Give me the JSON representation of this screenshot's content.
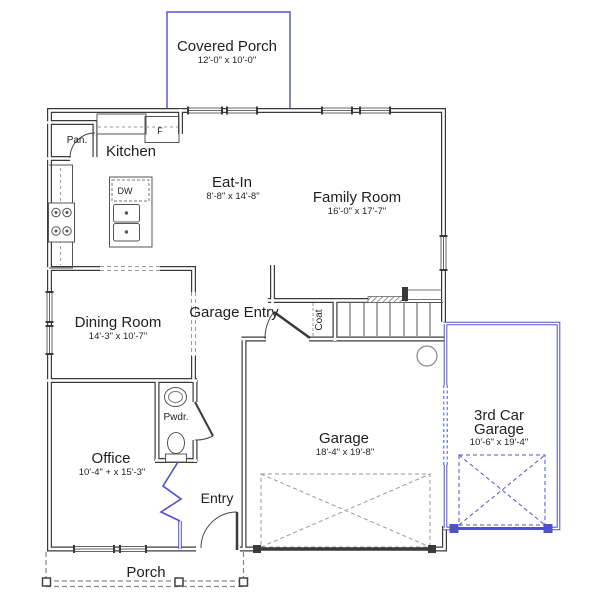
{
  "plan": {
    "rooms": {
      "covered_porch": {
        "name": "Covered Porch",
        "dims": "12'-0\" x 10'-0\""
      },
      "kitchen": {
        "name": "Kitchen"
      },
      "pantry": {
        "name": "Pan."
      },
      "eat_in": {
        "name": "Eat-In",
        "dims": "8'-8\" x 14'-8\""
      },
      "family_room": {
        "name": "Family Room",
        "dims": "16'-0\" x 17'-7\""
      },
      "dining_room": {
        "name": "Dining Room",
        "dims": "14'-3\" x 10'-7\""
      },
      "garage_entry": {
        "name": "Garage Entry"
      },
      "coat_closet": {
        "name": "Coat"
      },
      "powder_room": {
        "name": "Pwdr."
      },
      "office": {
        "name": "Office",
        "dims": "10'-4\" + x 15'-3\""
      },
      "entry": {
        "name": "Entry"
      },
      "garage": {
        "name": "Garage",
        "dims": "18'-4\" x 19'-8\""
      },
      "third_car_garage": {
        "name_line1": "3rd Car",
        "name_line2": "Garage",
        "dims": "10'-6\" x 19'-4\""
      },
      "porch": {
        "name": "Porch"
      }
    },
    "appliances": {
      "refrigerator": "F",
      "dishwasher": "DW"
    },
    "colors": {
      "wall": "#3a3a3a",
      "optional_blue": "#5050cf",
      "dashed": "#999999",
      "text": "#1f1f1f",
      "background": "#ffffff"
    }
  }
}
